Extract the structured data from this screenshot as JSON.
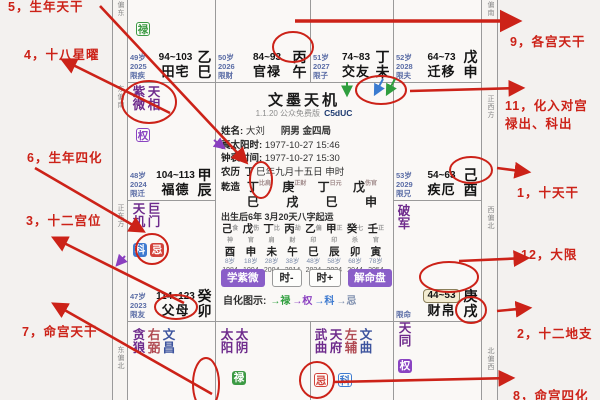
{
  "ann": {
    "a5": "5，生年天干",
    "a4": "4，十八星曜",
    "a6": "6，生年四化",
    "a3": "3，十二宫位",
    "a7": "7，命宫天干",
    "a9": "9，各宫天干",
    "a11a": "11，化入对宫",
    "a11b": "禄出、科出",
    "a1": "1，十天干",
    "a12": "12，大限",
    "a2": "2，十二地支",
    "a8": "8，命宫四化"
  },
  "compass": {
    "left": [
      "偏东",
      "东偏南",
      "正东方",
      "东偏北"
    ],
    "right": [
      "偏南",
      "正西方",
      "西偏北",
      "北偏西"
    ]
  },
  "badge": {
    "lu": "禄",
    "quan": "权",
    "ke": "科",
    "ji": "忌"
  },
  "palaces": {
    "si": {
      "age": "49岁",
      "year": "2025",
      "lim": "限疾",
      "range": "94~103",
      "name": "田宅",
      "stem": "乙",
      "branch": "巳"
    },
    "wu": {
      "age": "50岁",
      "year": "2026",
      "lim": "限财",
      "range": "84~93",
      "name": "官禄",
      "stem": "丙",
      "branch": "午"
    },
    "wei": {
      "age": "51岁",
      "year": "2027",
      "lim": "限子",
      "range": "74~83",
      "name": "交友",
      "stem": "丁",
      "branch": "未"
    },
    "shen": {
      "age": "52岁",
      "year": "2028",
      "lim": "限夫",
      "range": "64~73",
      "name": "迁移",
      "stem": "戊",
      "branch": "申"
    },
    "you": {
      "age": "53岁",
      "year": "2029",
      "lim": "限兄",
      "range": "54~63",
      "name": "疾厄",
      "stem": "己",
      "branch": "酉"
    },
    "xu": {
      "lim": "限命",
      "range": "44~53",
      "name": "财帛",
      "stem": "庚",
      "branch": "戌"
    },
    "chen": {
      "age": "48岁",
      "year": "2024",
      "lim": "限迁",
      "range": "104~113",
      "name": "福德",
      "stem": "甲",
      "branch": "辰"
    },
    "mao": {
      "age": "47岁",
      "year": "2023",
      "lim": "限友",
      "range": "114~123",
      "name": "父母",
      "stem": "癸",
      "branch": "卯"
    }
  },
  "stars": {
    "chen": [
      {
        "t": "紫微",
        "c": "m"
      },
      {
        "t": "天相",
        "c": "m"
      }
    ],
    "mao": [
      {
        "t": "天机",
        "c": "m"
      },
      {
        "t": "巨门",
        "c": "m"
      }
    ],
    "xu": [
      {
        "t": "破军",
        "c": "m"
      }
    ],
    "yin": [
      {
        "t": "贪狼",
        "c": "m"
      },
      {
        "t": "右弼",
        "c": "a"
      },
      {
        "t": "文昌",
        "c": "w"
      }
    ],
    "chou": [
      {
        "t": "太阳",
        "c": "m"
      },
      {
        "t": "太阴",
        "c": "m"
      }
    ],
    "zi": [
      {
        "t": "武曲",
        "c": "m"
      },
      {
        "t": "天府",
        "c": "m"
      },
      {
        "t": "左辅",
        "c": "a"
      },
      {
        "t": "文曲",
        "c": "w"
      }
    ],
    "hai": [
      {
        "t": "天同",
        "c": "m"
      }
    ]
  },
  "center": {
    "title": "文墨天机",
    "version": "1.1.20 公众免费版",
    "code": "C5dUC",
    "name_label": "姓名:",
    "name": "大刘",
    "kind": "阴男 金四局",
    "sun_label": "真太阳时:",
    "sun": "1977-10-27  15:46",
    "clock_label": "钟表时间:",
    "clock": "1977-10-27  15:30",
    "lunar_label": "农历",
    "lunar_stem": "丁",
    "lunar_rest": "巳年九月十五日 申时",
    "qz_label": "乾造",
    "bazi_stems": [
      {
        "t": "丁",
        "g": "比肩"
      },
      {
        "t": "庚",
        "g": "正财"
      },
      {
        "t": "丁",
        "g": "日元"
      },
      {
        "t": "戊",
        "g": "伤官"
      }
    ],
    "bazi_branches": [
      "巳",
      "戌",
      "巳",
      "申"
    ],
    "start": "出生后6年 3月20天八字起运",
    "luck": [
      {
        "s": "己",
        "g": "食神",
        "b": "酉",
        "a": "8岁",
        "y": "1984"
      },
      {
        "s": "戊",
        "g": "伤官",
        "b": "申",
        "a": "18岁",
        "y": "1994"
      },
      {
        "s": "丁",
        "g": "比肩",
        "b": "未",
        "a": "28岁",
        "y": "2004"
      },
      {
        "s": "丙",
        "g": "劫财",
        "b": "午",
        "a": "38岁",
        "y": "2014"
      },
      {
        "s": "乙",
        "g": "偏印",
        "b": "巳",
        "a": "48岁",
        "y": "2024"
      },
      {
        "s": "甲",
        "g": "正印",
        "b": "辰",
        "a": "58岁",
        "y": "2034"
      },
      {
        "s": "癸",
        "g": "七杀",
        "b": "卯",
        "a": "68岁",
        "y": "2044"
      },
      {
        "s": "壬",
        "g": "正官",
        "b": "寅",
        "a": "78岁",
        "y": "2054"
      }
    ],
    "btn1": "学紫微",
    "btn2": "时-",
    "btn3": "时+",
    "btn4": "解命盘",
    "legend_label": "自化图示:",
    "legend_lu": "→禄",
    "legend_quan": "→权",
    "legend_ke": "→科",
    "legend_ji": "→忌"
  },
  "colors": {
    "annotation_red": "#cc2218",
    "lu_green": "#3c9a44",
    "quan_purple": "#8a44c2",
    "ke_blue": "#3f7bd0",
    "ji_red": "#d2423a"
  }
}
